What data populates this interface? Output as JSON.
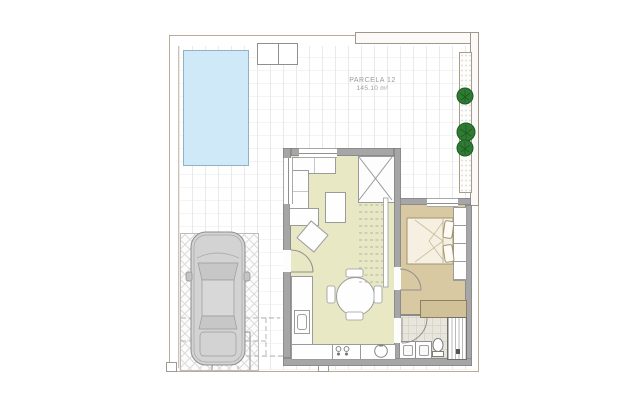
{
  "plan": {
    "parcel_label": "PARCELA 12",
    "parcel_area": "145.10 m²"
  },
  "colors": {
    "pool": "#cfe9f8",
    "living_floor": "#e8e9c4",
    "bedroom_floor": "#d8c9a2",
    "wardrobe": "#d0c198",
    "wall": "#a6a6a6",
    "plant_green": "#2f7b33",
    "car_body": "#d3d3d3",
    "boundary": "#b9ac94"
  },
  "icons": {
    "pool": "swimming-pool",
    "car": "car-top-view",
    "plants": "bush",
    "bed": "double-bed",
    "toilet": "toilet",
    "shower": "shower-tray",
    "stove": "cooktop-burners",
    "sink": "kitchen-sink",
    "table": "round-dining-table",
    "sofa": "l-shaped-sofa",
    "stairs": "staircase"
  },
  "counts": {
    "plants": 3,
    "dining_chairs": 4
  }
}
